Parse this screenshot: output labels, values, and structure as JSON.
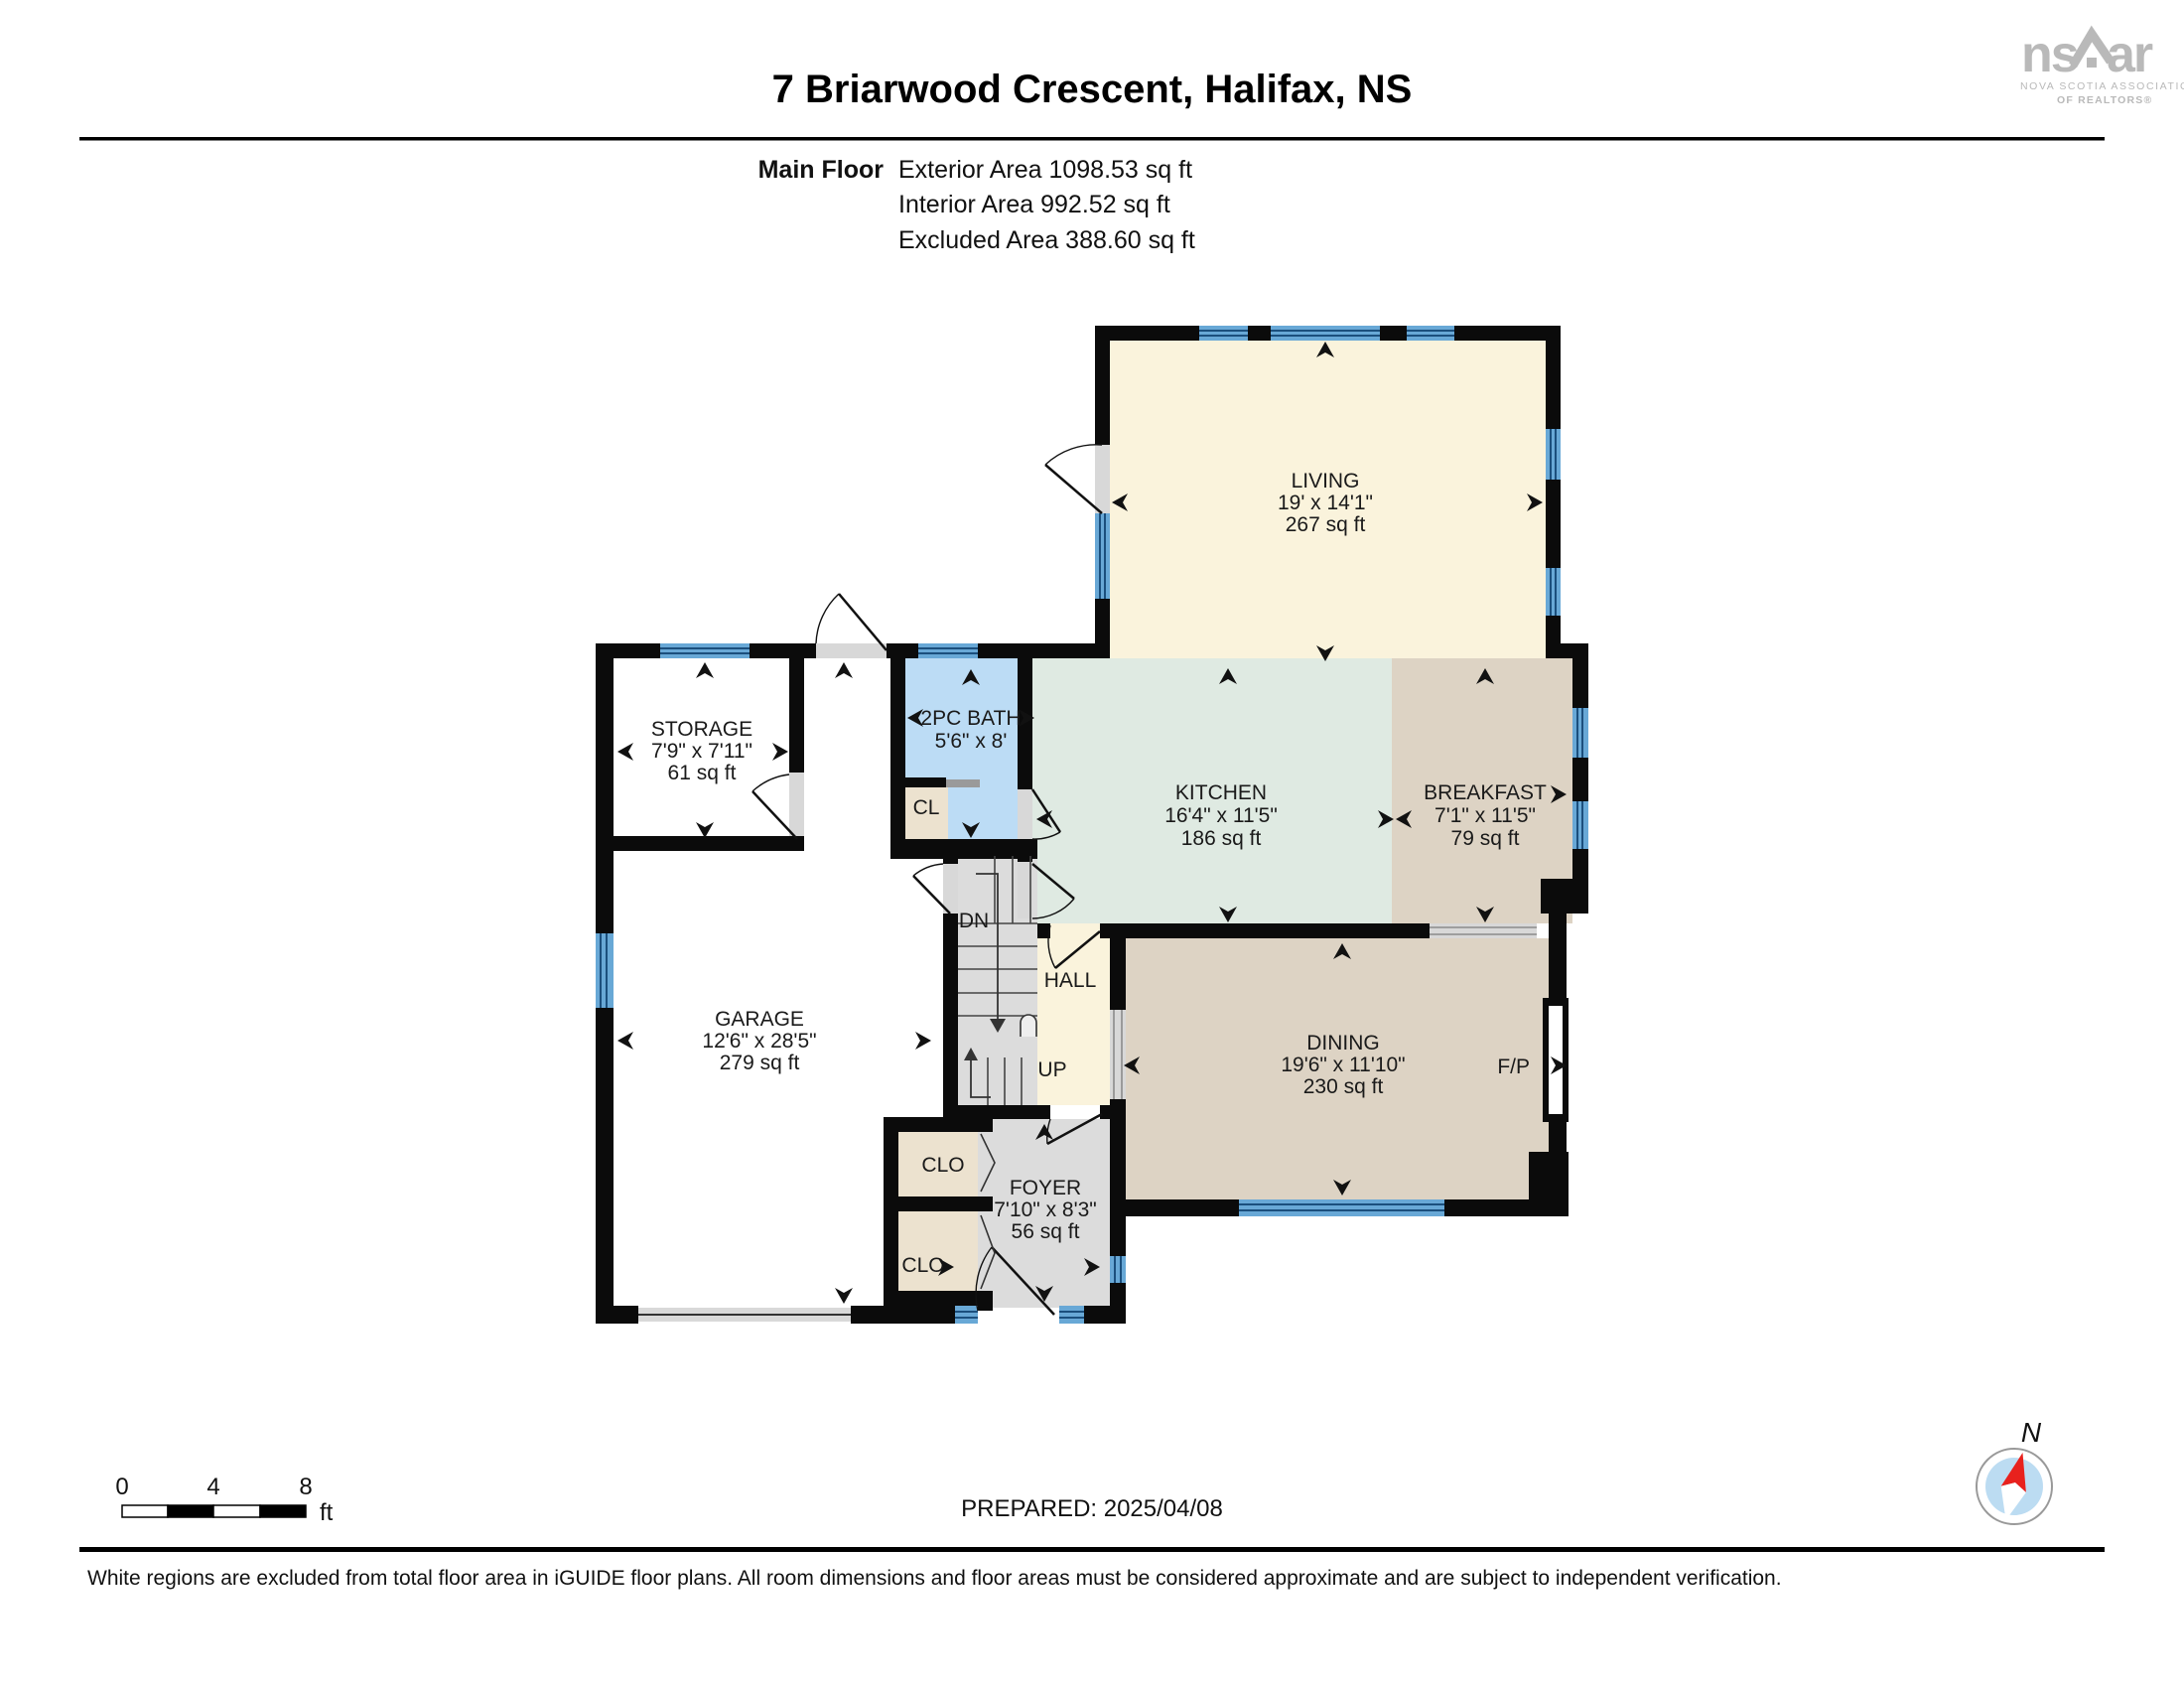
{
  "header": {
    "title": "7 Briarwood Crescent, Halifax, NS",
    "floor_label": "Main Floor",
    "areas": [
      "Exterior Area 1098.53 sq ft",
      "Interior Area 992.52 sq ft",
      "Excluded Area 388.60 sq ft"
    ]
  },
  "logo": {
    "ns": "ns",
    "ar": "ar",
    "line1": "NOVA SCOTIA ASSOCIATION",
    "line2": "OF REALTORS®"
  },
  "rooms": {
    "living": {
      "name": "LIVING",
      "dims": "19' x 14'1\"",
      "area": "267 sq ft"
    },
    "kitchen": {
      "name": "KITCHEN",
      "dims": "16'4\" x 11'5\"",
      "area": "186 sq ft"
    },
    "breakfast": {
      "name": "BREAKFAST",
      "dims": "7'1\" x 11'5\"",
      "area": "79 sq ft"
    },
    "dining": {
      "name": "DINING",
      "dims": "19'6\" x 11'10\"",
      "area": "230 sq ft"
    },
    "storage": {
      "name": "STORAGE",
      "dims": "7'9\" x 7'11\"",
      "area": "61 sq ft"
    },
    "garage": {
      "name": "GARAGE",
      "dims": "12'6\" x 28'5\"",
      "area": "279 sq ft"
    },
    "bath": {
      "name": "2PC BATH",
      "dims": "5'6\" x 8'"
    },
    "foyer": {
      "name": "FOYER",
      "dims": "7'10\" x 8'3\"",
      "area": "56 sq ft"
    },
    "hall": {
      "name": "HALL"
    }
  },
  "labels": {
    "up": "UP",
    "dn": "DN",
    "cl": "CL",
    "clo_upper": "CLO",
    "clo_lower": "CLO",
    "fp": "F/P"
  },
  "footer": {
    "scale_ticks": [
      "0",
      "4",
      "8"
    ],
    "scale_unit": "ft",
    "prepared": "PREPARED: 2025/04/08",
    "compass_north": "N",
    "disclaimer": "White regions are excluded from total floor area in iGUIDE floor plans. All room dimensions and floor areas must be considered approximate and are subject to independent verification."
  },
  "colors": {
    "wall": "#0b0b0b",
    "window": "#68a8d6",
    "window_line": "#1b4f7d",
    "living": "#faf3dc",
    "kitchen": "#dfeae2",
    "tan": "#ddd3c4",
    "bath": "#bcdcf5",
    "closet": "#ece2cf",
    "gray_floor": "#dcdcdc",
    "door_gray": "#d8d8d8",
    "logo_gray": "#b9b9b9",
    "compass_blue": "#bcdcf2",
    "compass_red": "#e8211d"
  }
}
